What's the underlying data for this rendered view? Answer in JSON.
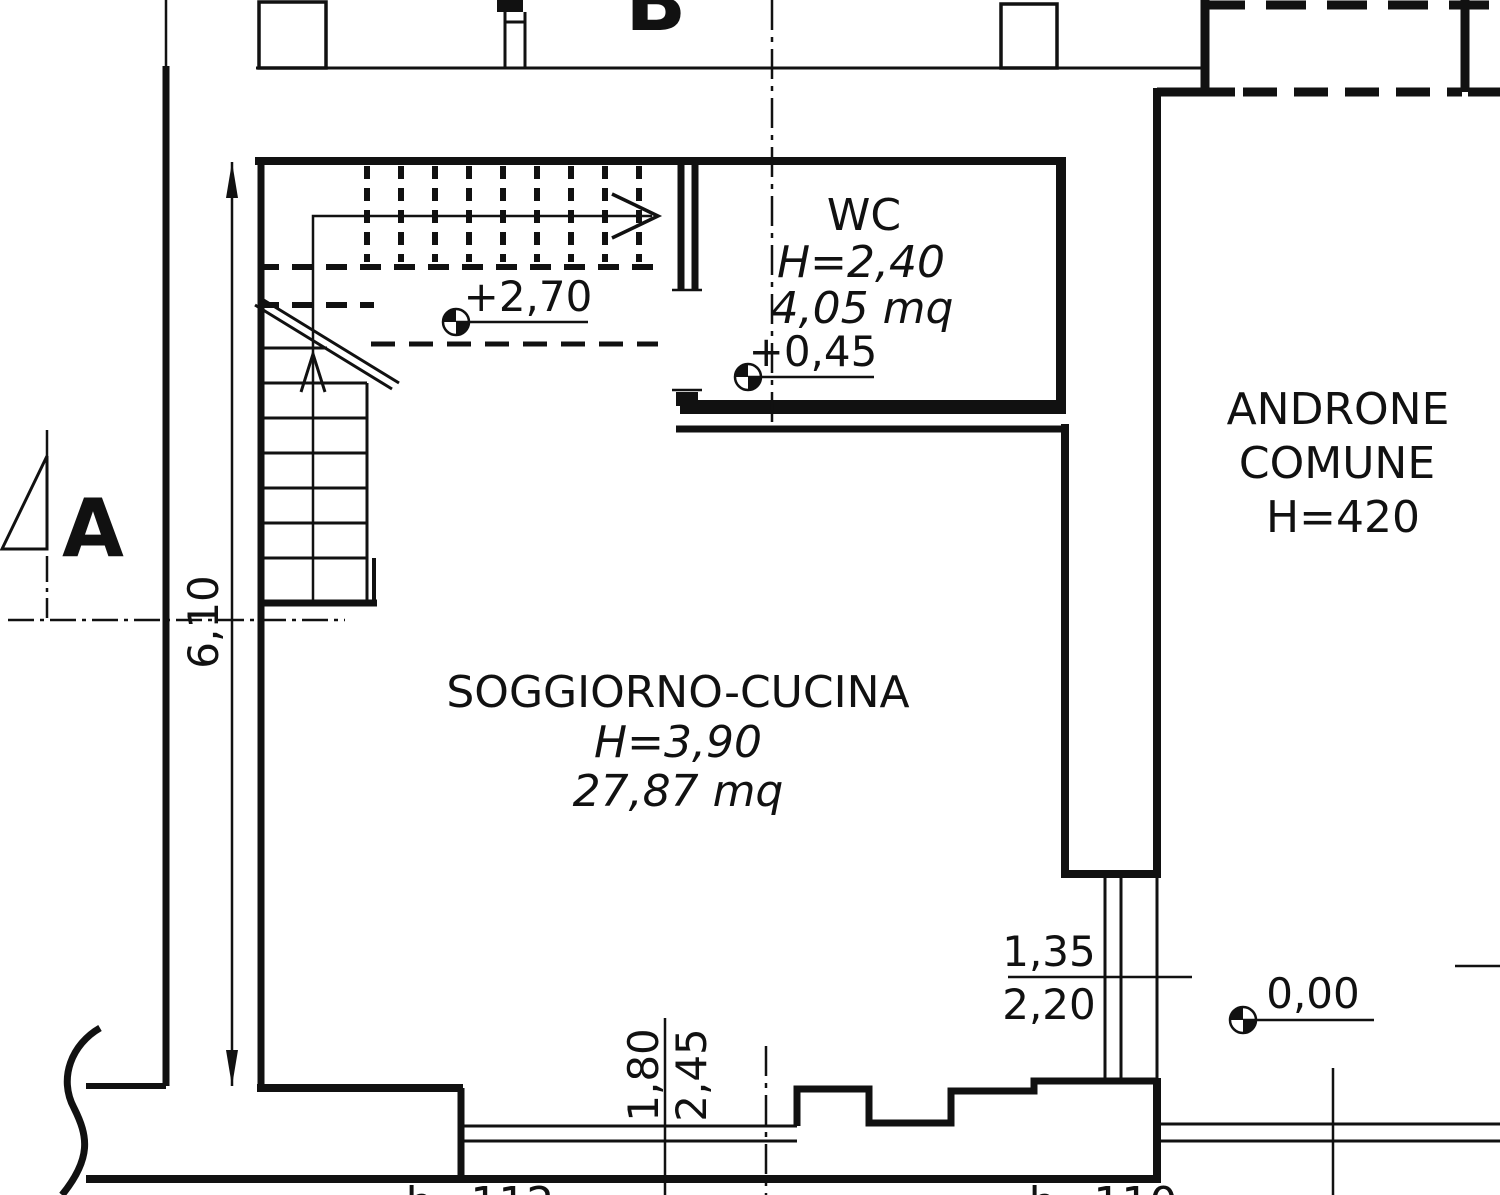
{
  "drawing": {
    "type": "architectural floor plan",
    "colors": {
      "ink": "#111111",
      "paper": "#ffffff"
    }
  },
  "rooms": {
    "soggiorno": {
      "name": "SOGGIORNO-CUCINA",
      "height": "H=3,90",
      "area": "27,87 mq"
    },
    "wc": {
      "name": "WC",
      "height": "H=2,40",
      "area": "4,05 mq"
    },
    "androne": {
      "name_line1": "ANDRONE",
      "name_line2": "COMUNE",
      "height": "H=420"
    }
  },
  "levels": {
    "mezzanine": "+2,70",
    "wc_floor": "+0,45",
    "ground": "0,00"
  },
  "dimensions": {
    "room_depth": "6,10",
    "passage_width": "1,35",
    "passage_height": "2,20",
    "window_width": "1,80",
    "window_height": "2,45"
  },
  "sections": {
    "a": "A",
    "b": "B'"
  },
  "fragments": {
    "bottom_left": "h=112",
    "bottom_right": "h=110"
  }
}
